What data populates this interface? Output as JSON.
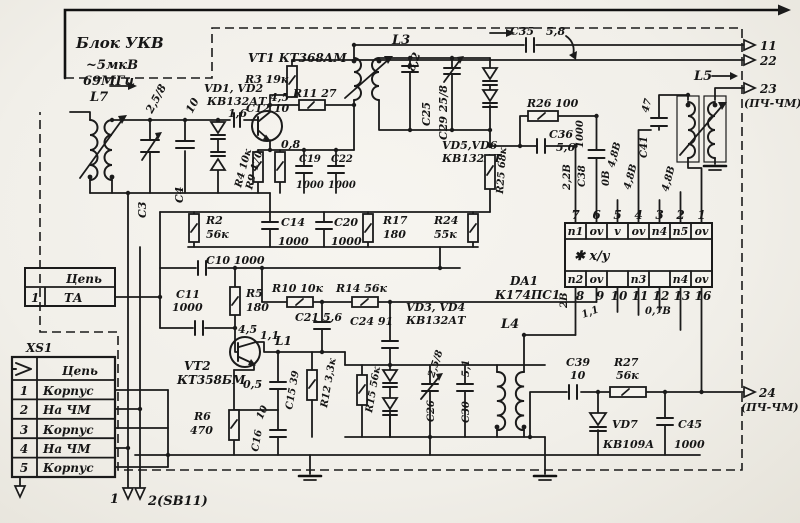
{
  "header": {
    "block": "Блок УКВ",
    "signal": "~5мкВ",
    "freq": "69МГц"
  },
  "outputs": {
    "p11": "11",
    "p22": "22",
    "p23": "23",
    "p23_note": "(ПЧ-ЧМ)",
    "p24": "24",
    "p24_note": "(ПЧ-ЧМ)",
    "bottom_left": "1",
    "bottom_right": "2(SB11)"
  },
  "tables": {
    "ta": {
      "header": "Цепь",
      "row_num": "1",
      "row_name": "ТА"
    },
    "xs1": {
      "title": "XS1",
      "header": "Цепь",
      "rows": [
        {
          "n": "1",
          "name": "Корпус"
        },
        {
          "n": "2",
          "name": "На ЧМ"
        },
        {
          "n": "3",
          "name": "Корпус"
        },
        {
          "n": "4",
          "name": "На ЧМ"
        },
        {
          "n": "5",
          "name": "Корпус"
        }
      ]
    }
  },
  "chip": {
    "ref": "DA1",
    "type": "К174ПС1",
    "func": "✱ x/y",
    "top_pins": [
      "7",
      "6",
      "5",
      "4",
      "3",
      "2",
      "1"
    ],
    "top_labels": [
      "п1",
      "ov",
      "v",
      "ov",
      "п4",
      "п5",
      "ov"
    ],
    "bottom_labels": [
      "п2",
      "ov",
      "",
      "п3",
      "",
      "п4",
      "ov"
    ],
    "bottom_pins": [
      "8",
      "9",
      "10",
      "11",
      "12",
      "13",
      "16"
    ]
  },
  "voltages": {
    "v16": "1,6",
    "v45_vt1": "4,5",
    "v08": "0,8",
    "v22": "2,2В",
    "v0": "0В",
    "v48_1": "4,8В",
    "v48_2": "4,8В",
    "v48_3": "4,8В",
    "v45_vt2": "4,5",
    "v11_vt2": "1,1",
    "v05": "0,5",
    "v2": "2В",
    "v11_da1": "1,1",
    "v07": "0,7В"
  },
  "components": {
    "l7": "L7",
    "l3": "L3",
    "l5": "L5",
    "l4": "L4",
    "l1": "L1",
    "vt1": "VT1  КТ368АМ",
    "vt2": "VT2",
    "vt2_type": "КТ358БМ",
    "vd12": "VD1, VD2",
    "vd12_type": "КВ132АТ",
    "vd56": "VD5,VD6",
    "vd56_type": "КВ132АТ",
    "vd34": "VD3, VD4",
    "vd34_type": "КВ132АТ",
    "vd7": "VD7",
    "vd7_type": "КВ109А",
    "r2": "R2",
    "r2_val": "56к",
    "r3": "R3 19к",
    "r4": "R4 10к",
    "r5": "R5",
    "r5_val": "180",
    "r6": "R6",
    "r6_val": "470",
    "r9": "R9 470",
    "r10": "R10 10к",
    "r11": "R11 27",
    "r12": "R12 3,3к",
    "r14": "R14 56к",
    "r15": "R15 56к",
    "r17": "R17",
    "r17_val": "180",
    "r24": "R24",
    "r24_val": "55к",
    "r25": "R25 68к",
    "r26": "R26 100",
    "r27": "R27",
    "r27_val": "56к",
    "c3": "С3",
    "c3_val": "2,5/8",
    "c4": "С4",
    "c4_val": "10",
    "c10": "С10 1000",
    "c11": "С11",
    "c11_val": "1000",
    "c12": "С12 10",
    "c14": "С14",
    "c14_val": "1000",
    "c15": "С15 39",
    "c16": "С16",
    "c16_val": "10",
    "c19": "С19",
    "c19_val": "1000",
    "c20": "С20",
    "c20_val": "1000",
    "c21": "С21 5,6",
    "c22": "С22",
    "c22_val": "1000",
    "c24": "С24 91",
    "c25": "С25",
    "c25_val": "8,2",
    "c26": "С26",
    "c26_val": "2,5/8",
    "c29": "С29 25/8",
    "c30": "С30",
    "c30_val": "5,1",
    "c35": "С35",
    "c35_val": "5,8",
    "c36": "С36",
    "c36_val": "5,6",
    "c38": "С38",
    "c38_val": "1000",
    "c39": "С39",
    "c39_val": "10",
    "c41": "С41",
    "c41_val": "47",
    "c45": "С45",
    "c45_val": "1000"
  }
}
